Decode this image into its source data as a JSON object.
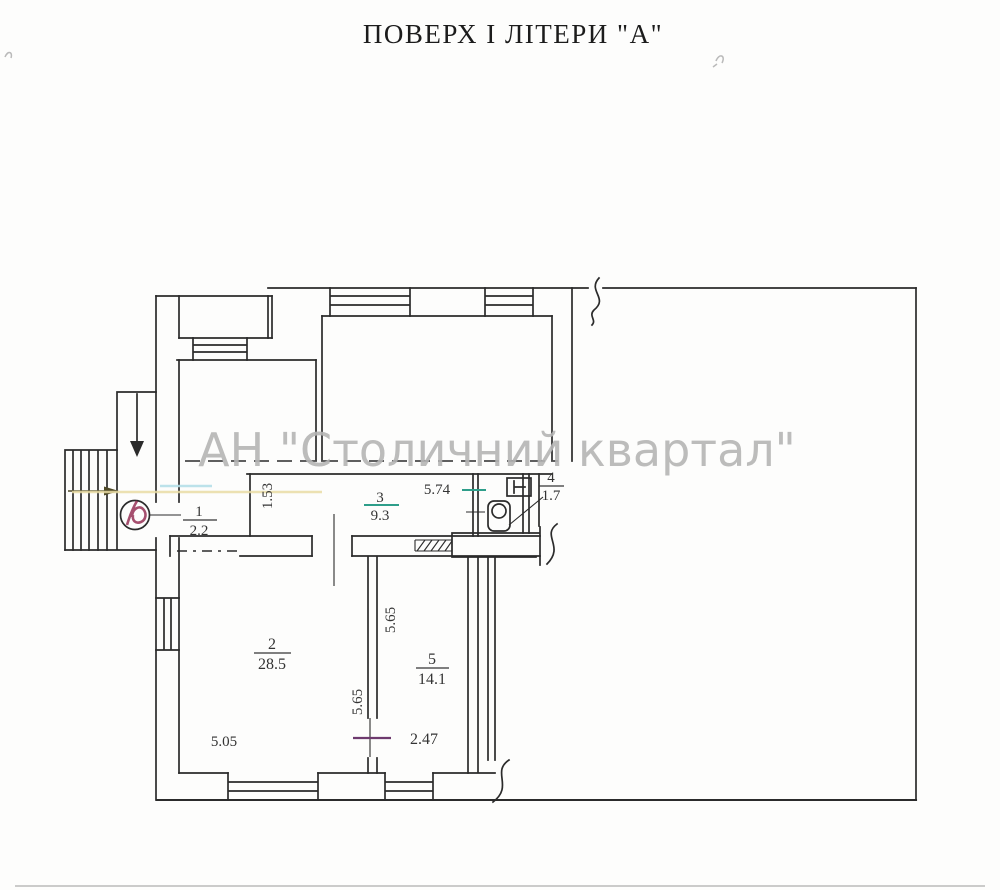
{
  "title": "ПОВЕРХ  І  ЛІТЕРИ \"А\"",
  "watermark": "АН \"Столичний квартал\"",
  "rooms": [
    {
      "number": "1",
      "area": "2.2"
    },
    {
      "number": "2",
      "area": "28.5"
    },
    {
      "number": "3",
      "area": "9.3"
    },
    {
      "number": "4",
      "area": "1.7"
    },
    {
      "number": "5",
      "area": "14.1"
    }
  ],
  "dimensions": {
    "corridor_length": "5.74",
    "corridor_width": "1.53",
    "room2_width": "5.05",
    "room2_depth": "5.65",
    "room5_depth": "5.65",
    "room5_width": "2.47"
  },
  "colors": {
    "line": "#2b2b2b",
    "watermark_gray": "#b5b5b5",
    "teal_mark": "#2e9e8a",
    "purple_mark": "#6e3a6e",
    "stamp_red": "#953055",
    "yellow_mark": "#e9dca4",
    "cyan_mark": "#b5dfe8"
  }
}
